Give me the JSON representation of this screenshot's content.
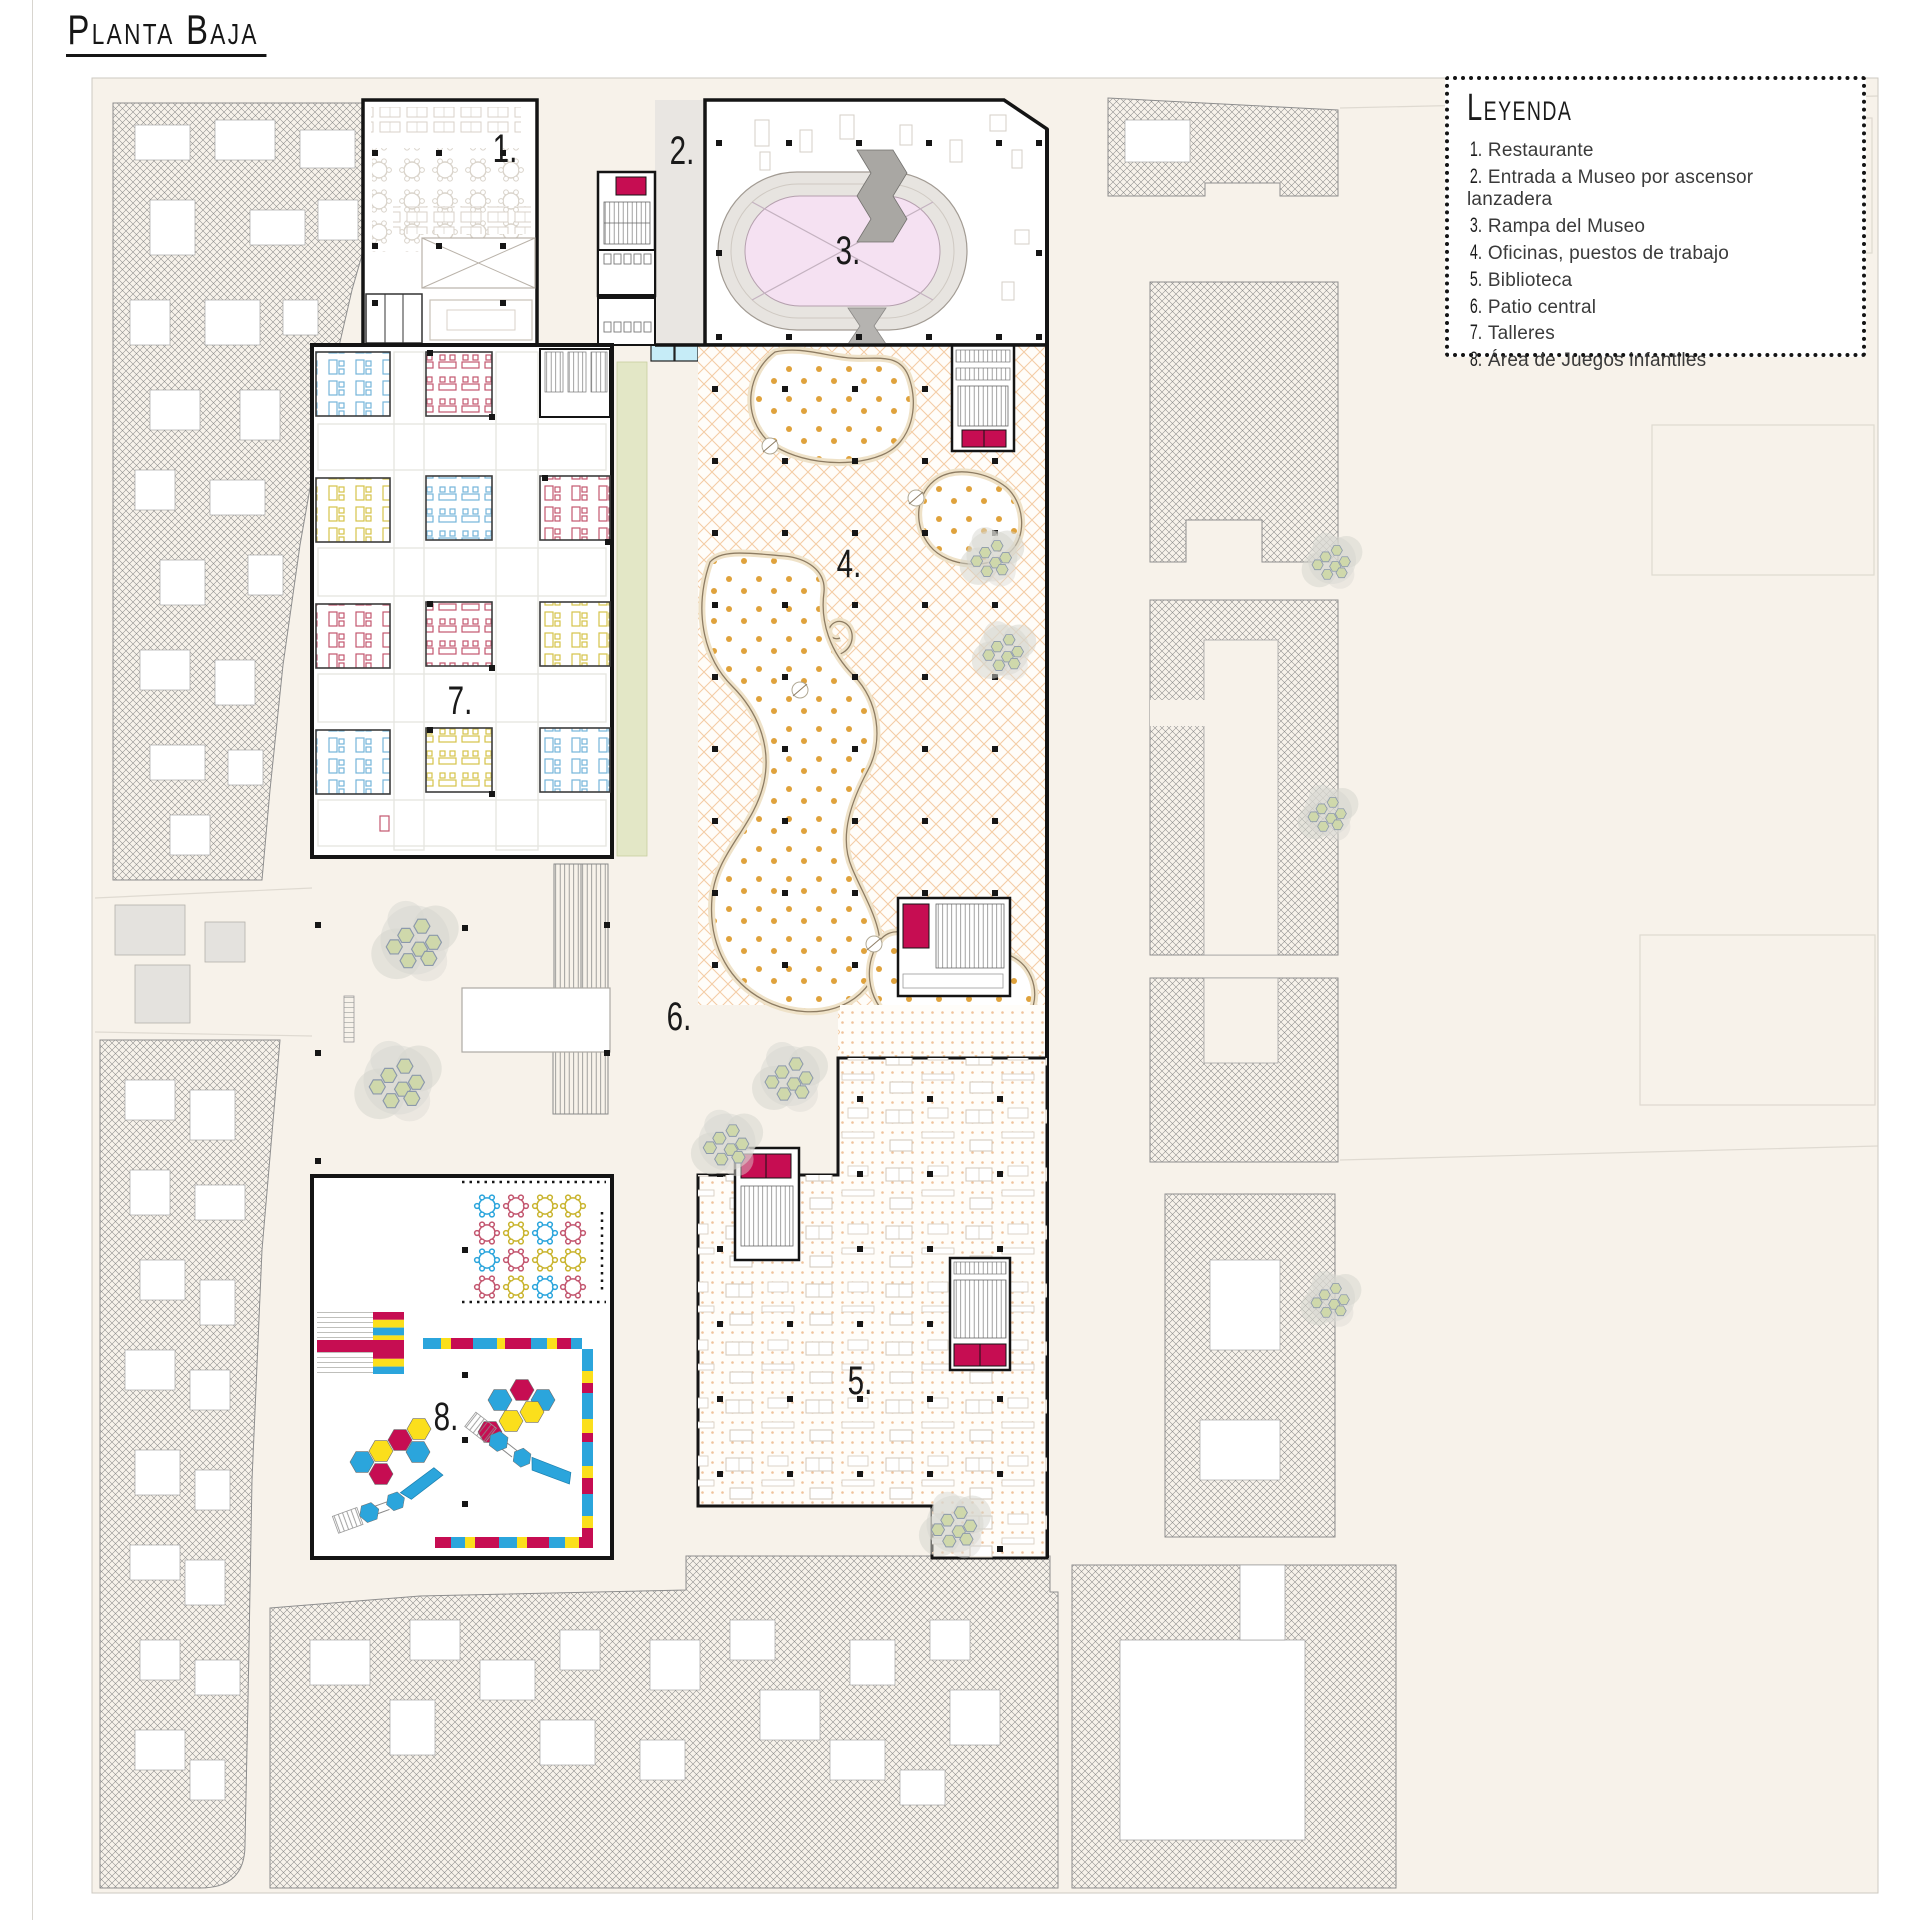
{
  "page": {
    "floor_title": "Planta Baja"
  },
  "legend": {
    "title": "Leyenda",
    "items": [
      {
        "num": "1.",
        "label": "Restaurante"
      },
      {
        "num": "2.",
        "label": "Entrada a Museo por ascensor lanzadera"
      },
      {
        "num": "3.",
        "label": "Rampa del Museo"
      },
      {
        "num": "4.",
        "label": "Oficinas, puestos de trabajo"
      },
      {
        "num": "5.",
        "label": "Biblioteca"
      },
      {
        "num": "6.",
        "label": "Patio central"
      },
      {
        "num": "7.",
        "label": "Talleres"
      },
      {
        "num": "8.",
        "label": "Área de Juegos infantiles"
      }
    ]
  },
  "plan": {
    "labels": [
      {
        "text": "1.",
        "name": "Restaurante"
      },
      {
        "text": "2.",
        "name": "Entrada a Museo por ascensor lanzadera"
      },
      {
        "text": "3.",
        "name": "Rampa del Museo"
      },
      {
        "text": "4.",
        "name": "Oficinas, puestos de trabajo"
      },
      {
        "text": "5.",
        "name": "Biblioteca"
      },
      {
        "text": "6.",
        "name": "Patio central"
      },
      {
        "text": "7.",
        "name": "Talleres"
      },
      {
        "text": "8.",
        "name": "Área de Juegos infantiles"
      }
    ]
  },
  "colors": {
    "accent_magenta": "#c60d52",
    "accent_cyan": "#2ba5dc",
    "accent_yellow": "#fbdf1c",
    "ramp_pink": "#f5e1f2",
    "plan_cream": "#f7f2ea",
    "green_strip": "#e3e7c6",
    "carpet_orange": "#f3cda6",
    "dot_orange": "#dfa23c",
    "desk_blue": "#74b5da",
    "desk_yellow": "#d5c34a",
    "desk_red": "#c3566f"
  }
}
